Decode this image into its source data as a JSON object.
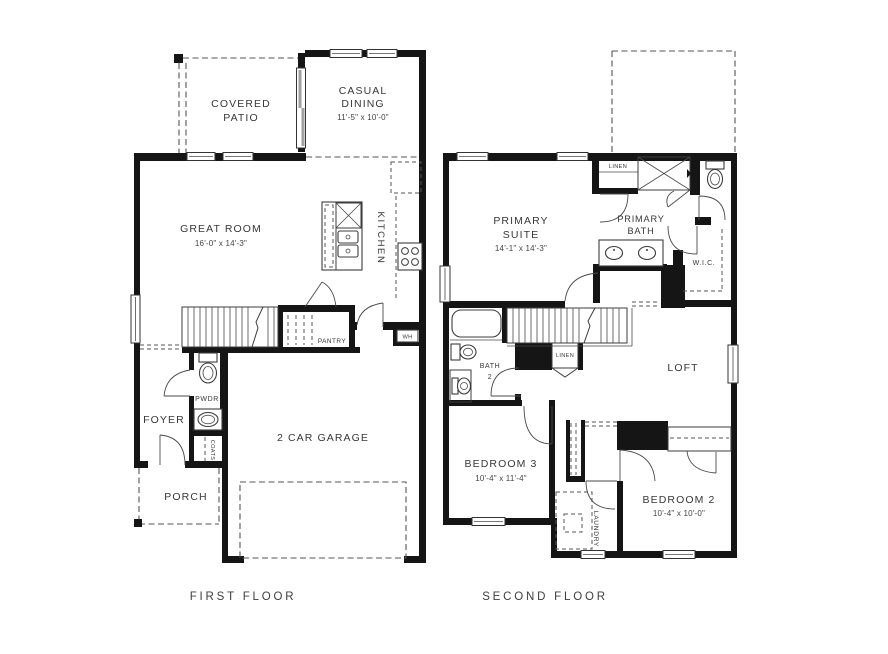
{
  "colors": {
    "background": "#ffffff",
    "wall": "#151515",
    "line": "#3c3c3c",
    "dash": "#555555",
    "text": "#383838",
    "slider_gray": "#a0a0a0"
  },
  "captions": {
    "first": "FIRST FLOOR",
    "second": "SECOND FLOOR"
  },
  "first": {
    "covered_patio": {
      "line1": "COVERED",
      "line2": "PATIO"
    },
    "casual_dining": {
      "line1": "CASUAL",
      "line2": "DINING",
      "dims": "11'-5\" x 10'-0\""
    },
    "great_room": {
      "name": "GREAT ROOM",
      "dims": "16'-0\" x 14'-3\""
    },
    "kitchen": {
      "name": "KITCHEN"
    },
    "pantry": {
      "name": "PANTRY"
    },
    "powder": {
      "name": "PWDR"
    },
    "foyer": {
      "name": "FOYER"
    },
    "coats": {
      "name": "COATS"
    },
    "porch": {
      "name": "PORCH"
    },
    "garage": {
      "name": "2 CAR GARAGE"
    },
    "water_heater": {
      "name": "WH"
    }
  },
  "second": {
    "primary_suite": {
      "line1": "PRIMARY",
      "line2": "SUITE",
      "dims": "14'-1\" x 14'-3\""
    },
    "primary_bath": {
      "line1": "PRIMARY",
      "line2": "BATH"
    },
    "linen_upper": {
      "name": "LINEN"
    },
    "wic": {
      "name": "W.I.C."
    },
    "bath2": {
      "line1": "BATH",
      "line2": "2"
    },
    "linen_lower": {
      "name": "LINEN"
    },
    "loft": {
      "name": "LOFT"
    },
    "bedroom3": {
      "name": "BEDROOM 3",
      "dims": "10'-4\" x 11'-4\""
    },
    "bedroom2": {
      "name": "BEDROOM 2",
      "dims": "10'-4\" x 10'-0\""
    },
    "laundry": {
      "name": "LAUNDRY"
    }
  }
}
